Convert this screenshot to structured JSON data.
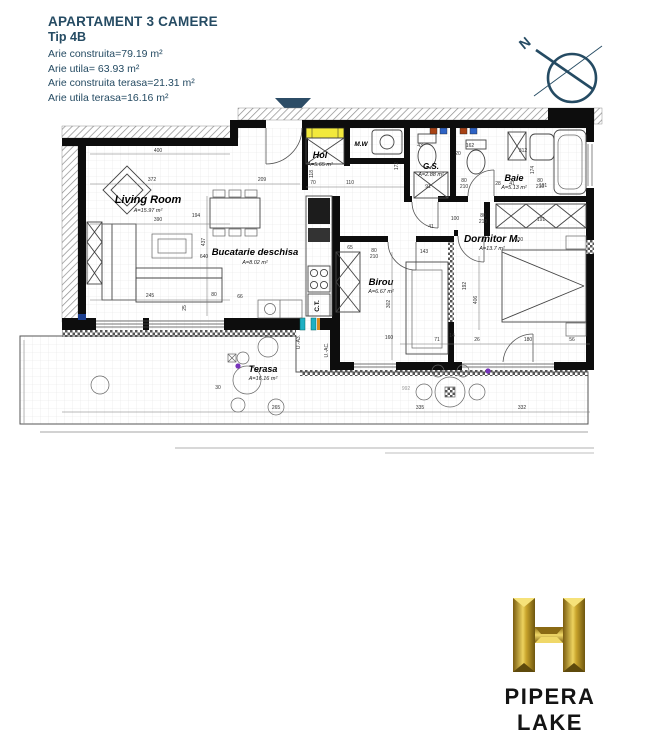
{
  "header": {
    "title": "APARTAMENT 3 CAMERE",
    "type_label": "Tip 4B",
    "area_lines": [
      "Arie construita=79.19 m²",
      "Arie utila= 63.93 m²",
      "Arie construita terasa=21.31 m²",
      "Arie utila terasa=16.16 m²"
    ]
  },
  "compass": {
    "north_label": "N"
  },
  "plan": {
    "rooms": {
      "living": {
        "name": "Living Room",
        "area": "A=15.97 m²"
      },
      "bucatarie": {
        "name": "Bucatarie deschisa",
        "area": "A=8.02 m²"
      },
      "hol": {
        "name": "Hol",
        "area": "A=5.65 m²"
      },
      "mw": {
        "name": "M.W"
      },
      "gs": {
        "name": "G.S.",
        "area": "A=2.88 m²"
      },
      "baie": {
        "name": "Baie",
        "area": "A=5.13 m²"
      },
      "dormitor": {
        "name": "Dormitor M.",
        "area": "A=13.7 m²"
      },
      "birou": {
        "name": "Birou",
        "area": "A=6.67 m²"
      },
      "terasa": {
        "name": "Terasa",
        "area": "A=16.16 m²"
      },
      "ct_label": "C.T.",
      "unit_label_a": "U.-A3.",
      "unit_label_b": "U.-AC."
    },
    "dims": {
      "d400": "400",
      "d372": "372",
      "d390": "390",
      "d209": "209",
      "d70": "70",
      "d110": "110",
      "d118": "118",
      "d194": "194",
      "d437": "437",
      "d640": "640",
      "d245": "245",
      "d80": "80",
      "d210": "210",
      "d66": "66",
      "d30": "30",
      "d265": "265",
      "d335": "335",
      "d332": "332",
      "d312": "312",
      "d174": "174",
      "d162": "162",
      "d172": "172",
      "d43": "43",
      "d20": "20",
      "d91": "91",
      "d28": "28",
      "d41": "41",
      "d100": "100",
      "d191": "191",
      "d330": "330",
      "d143": "143",
      "d192": "192",
      "d406": "406",
      "d302": "302",
      "d160": "160",
      "d71": "71",
      "d14": "14",
      "d26": "26",
      "d180": "180",
      "d56": "56",
      "d65": "65",
      "d25": "25",
      "d992": "992"
    }
  },
  "footer": {
    "brand": "PIPERA LAKE"
  },
  "colors": {
    "accent_navy": "#2c4c66",
    "panel_yellow": "#f2e93c",
    "window_teal": "#1fb0c4",
    "logo_gold": "#c9a42c"
  }
}
